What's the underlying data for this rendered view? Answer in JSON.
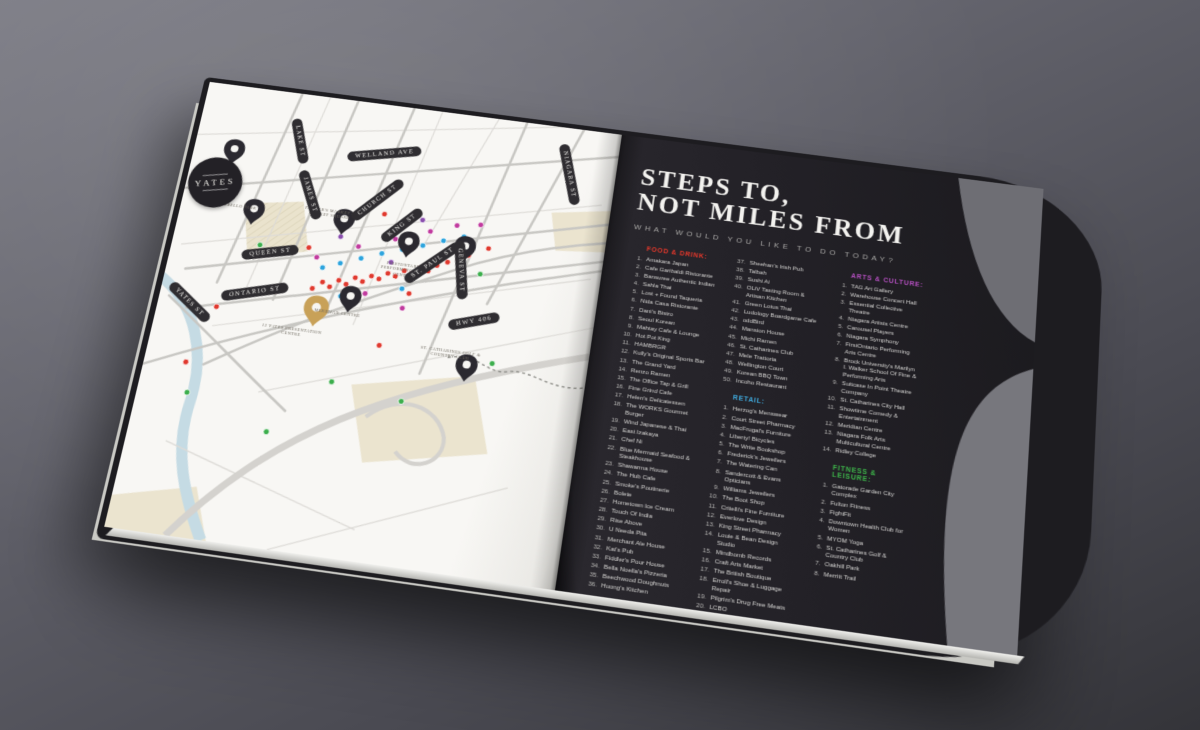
{
  "scene": {
    "background_top": "#7b7b84",
    "background_bottom": "#343439"
  },
  "map": {
    "logo_text": "YATES",
    "streets": [
      "NIAGARA ST",
      "LAKE ST",
      "WELLAND AVE",
      "JAMES ST",
      "CHURCH ST",
      "KING ST",
      "ST. PAUL ST",
      "GENEVA ST",
      "QUEEN ST",
      "ONTARIO ST",
      "YATES ST",
      "HWY 406"
    ],
    "places": [
      "Montebello Park",
      "Farmer's Market & Market Square",
      "Meridian Centre",
      "12 Yates Presentation Centre",
      "FirstOntario Performing Arts Centre",
      "St. Catharines Golf & Country Club"
    ],
    "marker_colors": {
      "red": "#e0392e",
      "blue": "#2da4dd",
      "magenta": "#c13a9e",
      "green": "#3cae4c",
      "purple": "#8a4fae",
      "gold": "#c8a158",
      "black": "#2b2930"
    },
    "dots": [
      {
        "x": 152,
        "y": 208,
        "c": "red"
      },
      {
        "x": 161,
        "y": 200,
        "c": "red"
      },
      {
        "x": 169,
        "y": 204,
        "c": "red"
      },
      {
        "x": 177,
        "y": 196,
        "c": "red"
      },
      {
        "x": 185,
        "y": 199,
        "c": "red"
      },
      {
        "x": 193,
        "y": 191,
        "c": "red"
      },
      {
        "x": 201,
        "y": 194,
        "c": "red"
      },
      {
        "x": 209,
        "y": 187,
        "c": "red"
      },
      {
        "x": 217,
        "y": 189,
        "c": "red"
      },
      {
        "x": 225,
        "y": 182,
        "c": "red"
      },
      {
        "x": 233,
        "y": 184,
        "c": "red"
      },
      {
        "x": 241,
        "y": 177,
        "c": "red"
      },
      {
        "x": 249,
        "y": 179,
        "c": "red"
      },
      {
        "x": 257,
        "y": 172,
        "c": "red"
      },
      {
        "x": 265,
        "y": 174,
        "c": "red"
      },
      {
        "x": 273,
        "y": 167,
        "c": "red"
      },
      {
        "x": 283,
        "y": 162,
        "c": "red"
      },
      {
        "x": 293,
        "y": 157,
        "c": "red"
      },
      {
        "x": 303,
        "y": 152,
        "c": "red"
      },
      {
        "x": 60,
        "y": 240,
        "c": "red"
      },
      {
        "x": 42,
        "y": 300,
        "c": "red"
      },
      {
        "x": 140,
        "y": 166,
        "c": "red"
      },
      {
        "x": 210,
        "y": 120,
        "c": "red"
      },
      {
        "x": 322,
        "y": 142,
        "c": "red"
      },
      {
        "x": 230,
        "y": 257,
        "c": "red"
      },
      {
        "x": 116,
        "y": 216,
        "c": "red"
      },
      {
        "x": 250,
        "y": 200,
        "c": "red"
      },
      {
        "x": 158,
        "y": 185,
        "c": "blue"
      },
      {
        "x": 175,
        "y": 178,
        "c": "blue"
      },
      {
        "x": 195,
        "y": 170,
        "c": "blue"
      },
      {
        "x": 215,
        "y": 162,
        "c": "blue"
      },
      {
        "x": 235,
        "y": 155,
        "c": "blue"
      },
      {
        "x": 255,
        "y": 148,
        "c": "blue"
      },
      {
        "x": 275,
        "y": 140,
        "c": "blue"
      },
      {
        "x": 295,
        "y": 133,
        "c": "blue"
      },
      {
        "x": 182,
        "y": 212,
        "c": "blue"
      },
      {
        "x": 242,
        "y": 196,
        "c": "blue"
      },
      {
        "x": 150,
        "y": 175,
        "c": "magenta"
      },
      {
        "x": 190,
        "y": 158,
        "c": "magenta"
      },
      {
        "x": 226,
        "y": 145,
        "c": "magenta"
      },
      {
        "x": 260,
        "y": 132,
        "c": "magenta"
      },
      {
        "x": 286,
        "y": 122,
        "c": "magenta"
      },
      {
        "x": 310,
        "y": 118,
        "c": "magenta"
      },
      {
        "x": 206,
        "y": 206,
        "c": "magenta"
      },
      {
        "x": 246,
        "y": 216,
        "c": "magenta"
      },
      {
        "x": 50,
        "y": 330,
        "c": "green"
      },
      {
        "x": 136,
        "y": 358,
        "c": "green"
      },
      {
        "x": 190,
        "y": 300,
        "c": "green"
      },
      {
        "x": 318,
        "y": 170,
        "c": "green"
      },
      {
        "x": 345,
        "y": 260,
        "c": "green"
      },
      {
        "x": 262,
        "y": 310,
        "c": "green"
      },
      {
        "x": 90,
        "y": 170,
        "c": "green"
      },
      {
        "x": 170,
        "y": 150,
        "c": "purple"
      },
      {
        "x": 250,
        "y": 121,
        "c": "purple"
      },
      {
        "x": 300,
        "y": 143,
        "c": "purple"
      },
      {
        "x": 226,
        "y": 170,
        "c": "purple"
      }
    ],
    "pins": [
      {
        "x": 42,
        "y": 88,
        "c": "black"
      },
      {
        "x": 76,
        "y": 150,
        "c": "black"
      },
      {
        "x": 170,
        "y": 148,
        "c": "black"
      },
      {
        "x": 240,
        "y": 163,
        "c": "black"
      },
      {
        "x": 192,
        "y": 228,
        "c": "black"
      },
      {
        "x": 298,
        "y": 160,
        "c": "black"
      },
      {
        "x": 320,
        "y": 282,
        "c": "black"
      },
      {
        "x": 160,
        "y": 247,
        "c": "gold",
        "s": 1.15
      }
    ]
  },
  "right_page": {
    "title_line1": "STEPS TO,",
    "title_line2": "NOT MILES FROM",
    "subtitle": "WHAT WOULD YOU LIKE TO DO TODAY?",
    "sections": {
      "food_drink": {
        "header": "FOOD & DRINK:",
        "color": "#e8382b",
        "items_col1": [
          "Amakara Japan",
          "Cafe Garibaldi Ristorante",
          "Bansuree Authentic Indian",
          "Sahla Thai",
          "Lost + Found Taqueria",
          "Nida Casa Ristorante",
          "Dani's Bistro",
          "Seoul Korean",
          "Mahtay Cafe & Lounge",
          "Hot Pot King",
          "HAMBRGR",
          "Kully's Original Sports Bar",
          "The Grand Yard",
          "Renzo Ramen",
          "The Office Tap & Grill",
          "Fine Grind Cafe",
          "Helen's Delicatessen",
          "The WORKS Gourmet Burger",
          "Wind Japanese & Thai",
          "East Izakaya",
          "Chef Ni",
          "Blue Mermaid Seafood & Steakhouse",
          "Shawarma House",
          "The Hub Cafe",
          "Smoke's Poutinerie",
          "Bolete",
          "Hometown Ice Cream",
          "Touch Of India",
          "Rise Above",
          "U Needa Pita",
          "Merchant Ale House",
          "Kat's Pub",
          "Fiddler's Pour House",
          "Bella Noella's Pizzeria",
          "Beechwood Doughnuts",
          "Huong's Kitchen"
        ],
        "items_col2": [
          "Sheehan's Irish Pub",
          "Talbah",
          "Sushi Ai",
          "OLiV Tasting Room & Artisan Kitchen",
          "Green Lotus Thai",
          "Ludology Boardgame Cafe",
          "oddBird",
          "Mansion House",
          "Michi Ramen",
          "St. Catharines Club",
          "Mele Trattoria",
          "Wellington Court",
          "Korean BBQ Town",
          "Incoho Restaurant"
        ],
        "col2_start": 37
      },
      "retail": {
        "header": "RETAIL:",
        "color": "#3fa9dc",
        "items": [
          "Herzog's Menswear",
          "Court Street Pharmacy",
          "MacFrugal's Furniture",
          "Liberty! Bicycles",
          "The Write Bookshop",
          "Frederick's Jewellers",
          "The Watering Can",
          "Sandercott & Evans Opticians",
          "Williams Jewellers",
          "The Boot Shop",
          "Critelli's Fine Furniture",
          "Everlove Design",
          "King Street Pharmacy",
          "Louie & Bean Design Studio",
          "Mindbomb Records",
          "Craft Arts Market",
          "The British Boutique",
          "Erroll's Shoe & Luggage Repair",
          "Pilgrim's Drug Free Meats",
          "LCBO"
        ]
      },
      "arts_culture": {
        "header": "ARTS & CULTURE:",
        "color": "#b44fc0",
        "items": [
          "TAG Art Gallery",
          "Warehouse Concert Hall",
          "Essential Collective Theatre",
          "Niagara Artists Centre",
          "Carousel Players",
          "Niagara Symphony",
          "FirstOntario Performing Arts Centre",
          "Brock University's Marilyn I. Walker School Of Fine & Performing Arts",
          "Suitcase In Point Theatre Company",
          "St. Catharines City Hall",
          "Showtime Comedy & Entertainment",
          "Meridian Centre",
          "Niagara Folk Arts Multicultural Centre",
          "Ridley College"
        ]
      },
      "fitness_leisure": {
        "header": "FITNESS & LEISURE:",
        "color": "#3db54a",
        "items": [
          "Gatorade Garden City Complex",
          "Fulton Fitness",
          "FightFit",
          "Downtown Health Club for Women",
          "MYOM Yoga",
          "St. Catharines Golf & Country Club",
          "Oakhill Park",
          "Merritt Trail"
        ]
      }
    }
  }
}
